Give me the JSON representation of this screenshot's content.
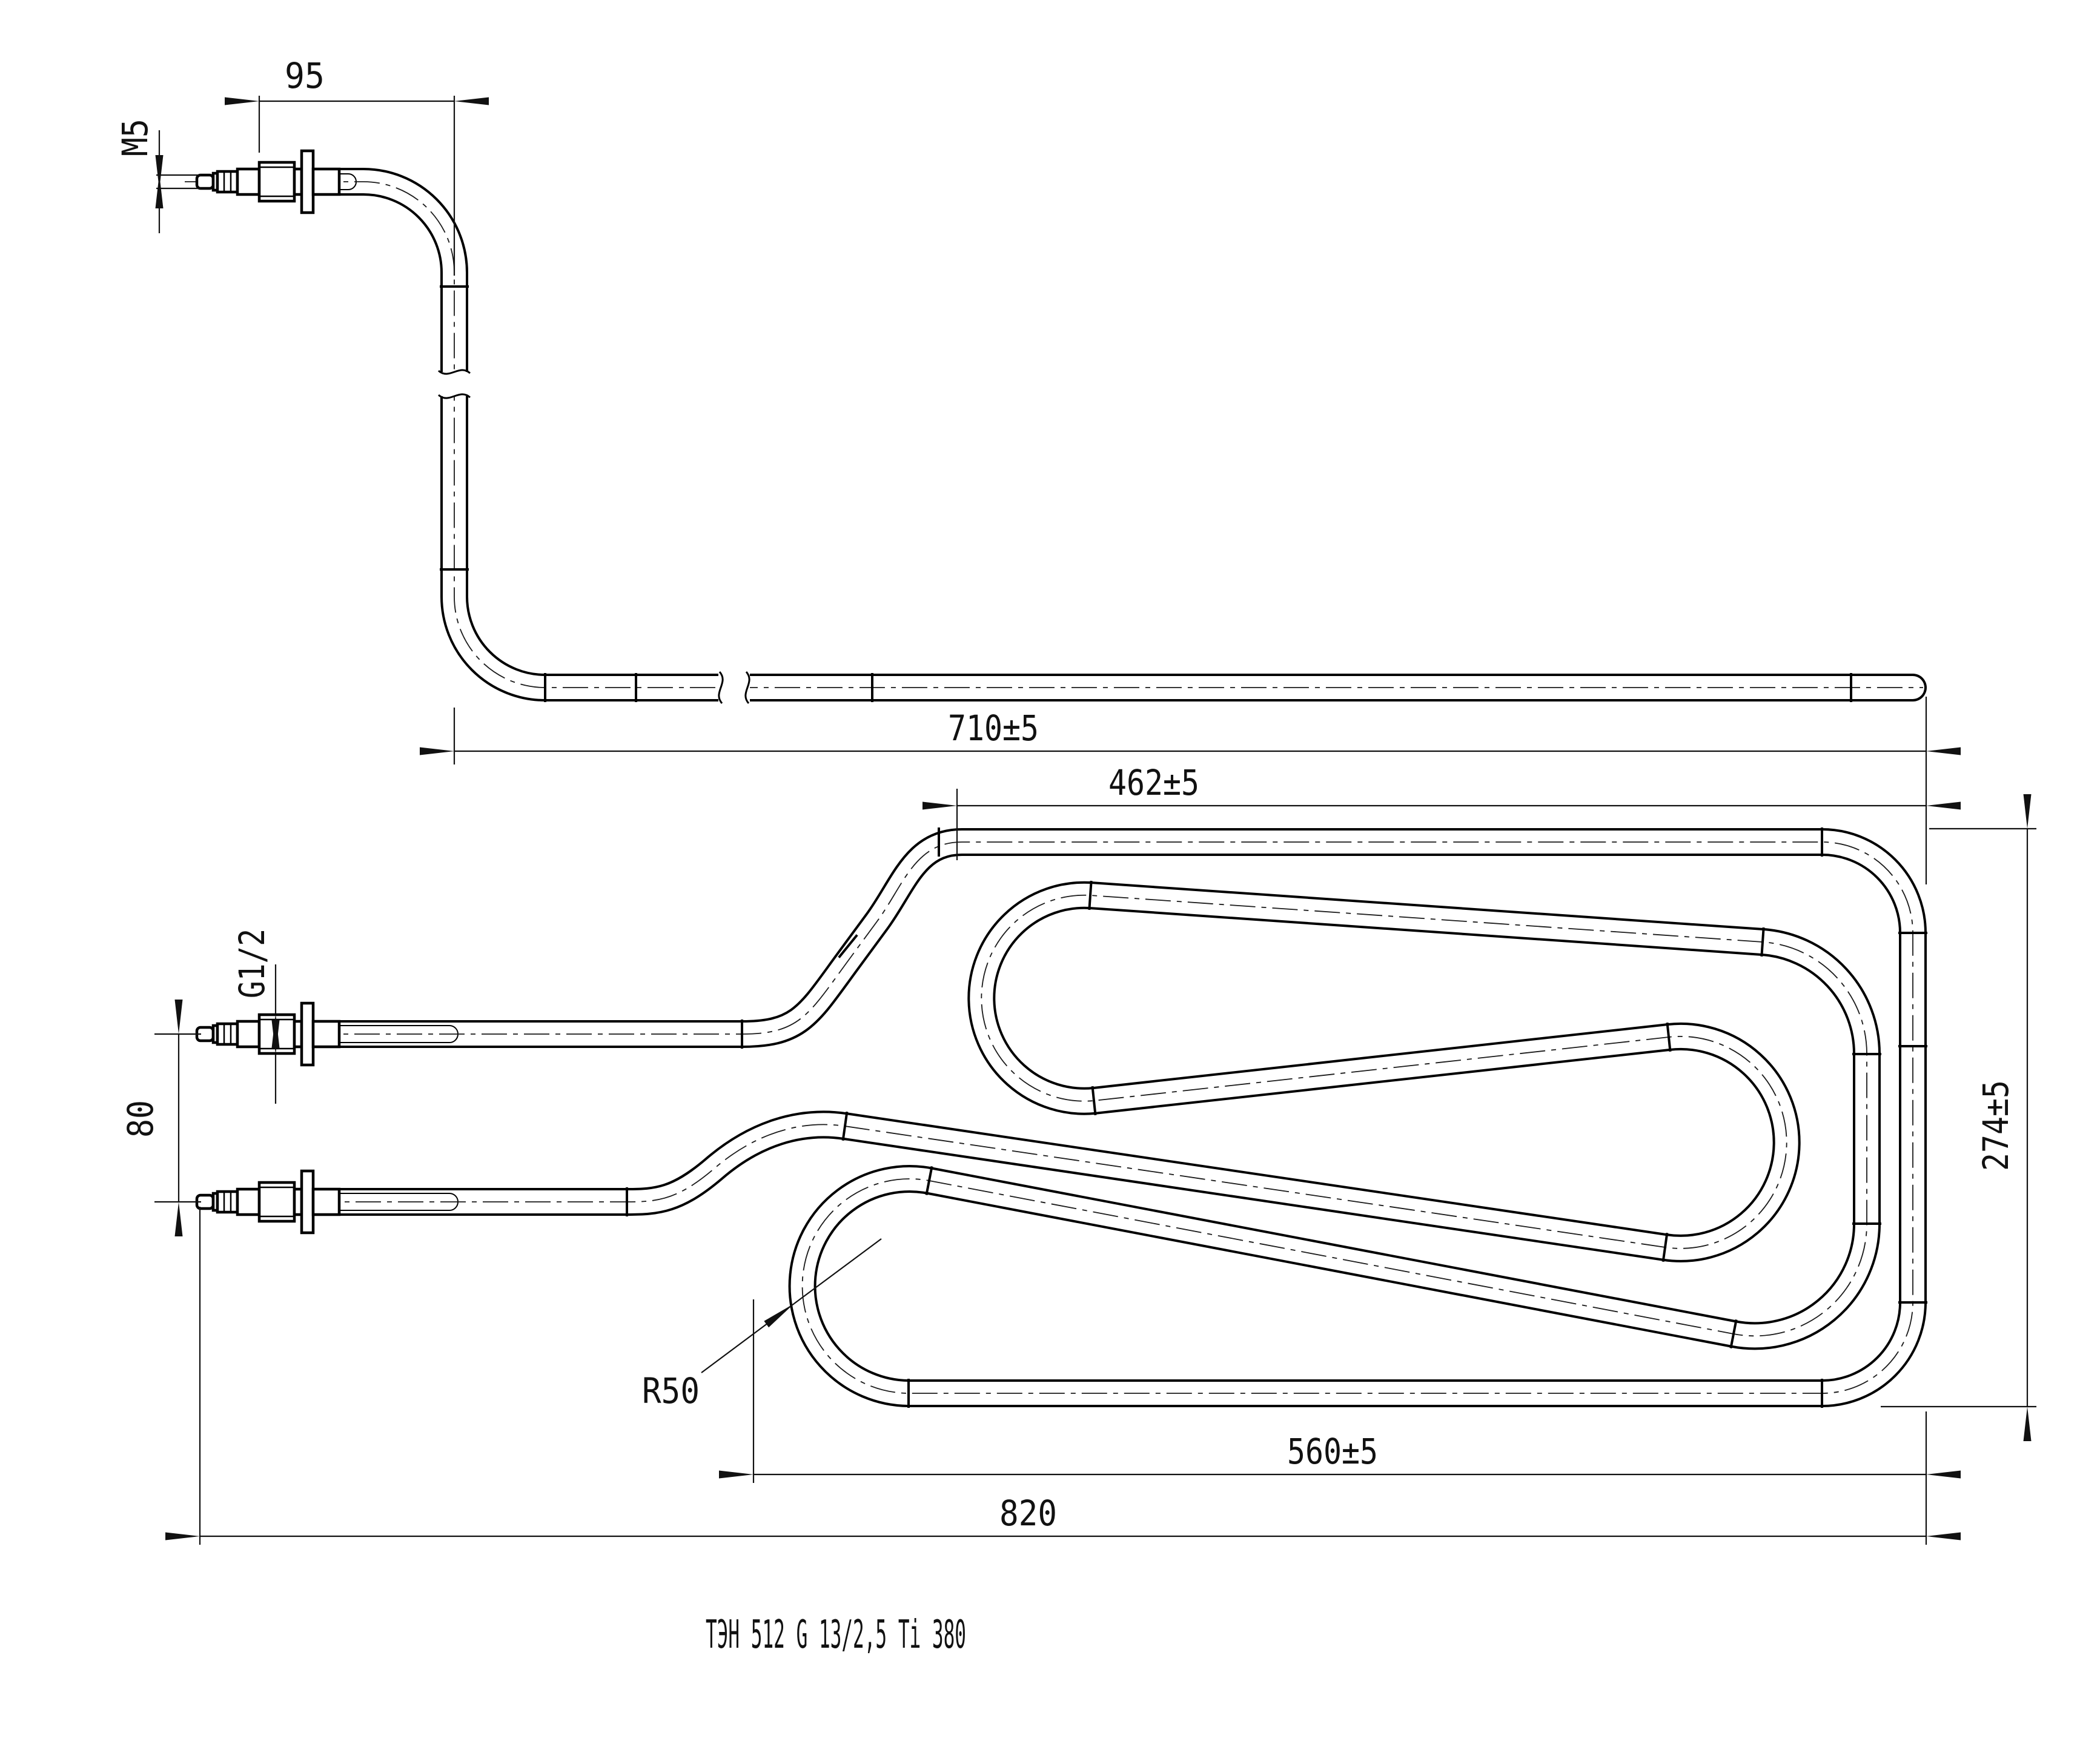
{
  "drawing": {
    "title": "ТЭН 512 G 13/2,5 Ti 380",
    "dimensions": {
      "stud_thread": "M5",
      "cold_end_length": "95",
      "lead_length": "710±5",
      "top_span": "462±5",
      "height": "274±5",
      "bottom_span": "560±5",
      "overall_length": "820",
      "terminal_spacing": "80",
      "bushing_thread": "G1/2",
      "bend_radius": "R50"
    }
  }
}
